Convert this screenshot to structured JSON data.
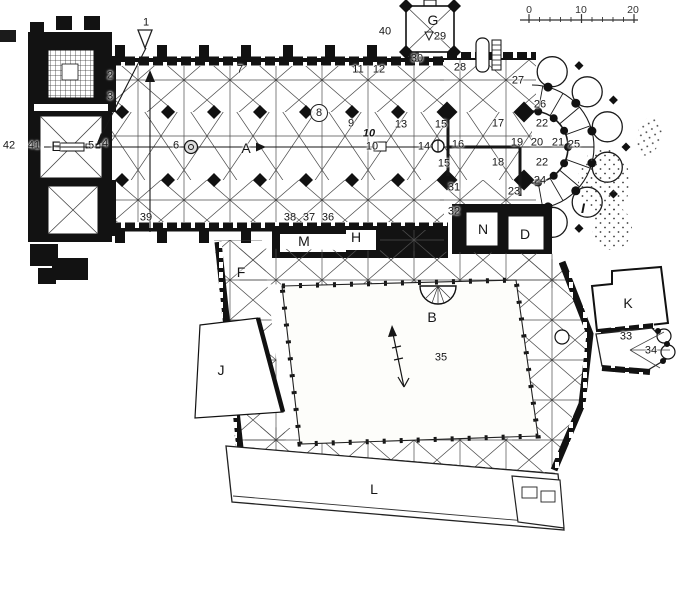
{
  "figure": {
    "kind": "architectural floor plan",
    "subject": "cathedral ground plan with cloister, scanned line drawing"
  },
  "scale_bar": {
    "labels": [
      "0",
      "10",
      "20"
    ]
  },
  "annotations": [
    {
      "text": "G",
      "x": 433,
      "y": 20,
      "kind": "ltr"
    },
    {
      "text": "E",
      "x": 56,
      "y": 146,
      "kind": "ltr"
    },
    {
      "text": "A",
      "x": 246,
      "y": 148,
      "kind": "ltr"
    },
    {
      "text": "I",
      "x": 583,
      "y": 208,
      "kind": "ltr",
      "italic": true
    },
    {
      "text": "N",
      "x": 483,
      "y": 229,
      "kind": "ltr"
    },
    {
      "text": "D",
      "x": 525,
      "y": 234,
      "kind": "ltr"
    },
    {
      "text": "M",
      "x": 304,
      "y": 241,
      "kind": "ltr"
    },
    {
      "text": "H",
      "x": 356,
      "y": 237,
      "kind": "ltr"
    },
    {
      "text": "F",
      "x": 241,
      "y": 272,
      "kind": "ltr"
    },
    {
      "text": "B",
      "x": 432,
      "y": 317,
      "kind": "ltr"
    },
    {
      "text": "J",
      "x": 221,
      "y": 370,
      "kind": "ltr"
    },
    {
      "text": "K",
      "x": 628,
      "y": 303,
      "kind": "ltr"
    },
    {
      "text": "L",
      "x": 374,
      "y": 489,
      "kind": "ltr"
    },
    {
      "text": "1",
      "x": 146,
      "y": 23,
      "kind": "num"
    },
    {
      "text": "2",
      "x": 110,
      "y": 76,
      "kind": "num"
    },
    {
      "text": "3",
      "x": 110,
      "y": 97,
      "kind": "num"
    },
    {
      "text": "4",
      "x": 105,
      "y": 144,
      "kind": "num"
    },
    {
      "text": "5",
      "x": 91,
      "y": 146,
      "kind": "num"
    },
    {
      "text": "6",
      "x": 176,
      "y": 146,
      "kind": "num"
    },
    {
      "text": "7",
      "x": 240,
      "y": 70,
      "kind": "num"
    },
    {
      "text": "8",
      "x": 319,
      "y": 113,
      "kind": "num",
      "circled": true
    },
    {
      "text": "9",
      "x": 351,
      "y": 124,
      "kind": "num"
    },
    {
      "text": "10",
      "x": 369,
      "y": 134,
      "kind": "num",
      "italic": true
    },
    {
      "text": "10",
      "x": 372,
      "y": 147,
      "kind": "num"
    },
    {
      "text": "11",
      "x": 358,
      "y": 70,
      "kind": "num"
    },
    {
      "text": "12",
      "x": 379,
      "y": 70,
      "kind": "num"
    },
    {
      "text": "13",
      "x": 401,
      "y": 125,
      "kind": "num"
    },
    {
      "text": "14",
      "x": 424,
      "y": 147,
      "kind": "num"
    },
    {
      "text": "15",
      "x": 441,
      "y": 125,
      "kind": "num"
    },
    {
      "text": "15",
      "x": 444,
      "y": 164,
      "kind": "num"
    },
    {
      "text": "16",
      "x": 458,
      "y": 145,
      "kind": "num"
    },
    {
      "text": "17",
      "x": 498,
      "y": 124,
      "kind": "num"
    },
    {
      "text": "18",
      "x": 498,
      "y": 163,
      "kind": "num"
    },
    {
      "text": "19",
      "x": 517,
      "y": 143,
      "kind": "num"
    },
    {
      "text": "20",
      "x": 537,
      "y": 143,
      "kind": "num"
    },
    {
      "text": "21",
      "x": 558,
      "y": 143,
      "kind": "num"
    },
    {
      "text": "22",
      "x": 542,
      "y": 124,
      "kind": "num"
    },
    {
      "text": "22",
      "x": 542,
      "y": 163,
      "kind": "num"
    },
    {
      "text": "23",
      "x": 514,
      "y": 192,
      "kind": "num"
    },
    {
      "text": "24",
      "x": 540,
      "y": 181,
      "kind": "num"
    },
    {
      "text": "25",
      "x": 574,
      "y": 145,
      "kind": "num"
    },
    {
      "text": "26",
      "x": 540,
      "y": 105,
      "kind": "num"
    },
    {
      "text": "27",
      "x": 518,
      "y": 81,
      "kind": "num"
    },
    {
      "text": "28",
      "x": 460,
      "y": 68,
      "kind": "num"
    },
    {
      "text": "29",
      "x": 440,
      "y": 37,
      "kind": "num"
    },
    {
      "text": "30",
      "x": 417,
      "y": 59,
      "kind": "num"
    },
    {
      "text": "31",
      "x": 454,
      "y": 188,
      "kind": "num"
    },
    {
      "text": "32",
      "x": 454,
      "y": 212,
      "kind": "num"
    },
    {
      "text": "33",
      "x": 626,
      "y": 337,
      "kind": "num"
    },
    {
      "text": "34",
      "x": 651,
      "y": 351,
      "kind": "num"
    },
    {
      "text": "35",
      "x": 441,
      "y": 358,
      "kind": "num"
    },
    {
      "text": "36",
      "x": 328,
      "y": 218,
      "kind": "num"
    },
    {
      "text": "37",
      "x": 309,
      "y": 218,
      "kind": "num"
    },
    {
      "text": "38",
      "x": 290,
      "y": 218,
      "kind": "num"
    },
    {
      "text": "39",
      "x": 146,
      "y": 218,
      "kind": "num"
    },
    {
      "text": "40",
      "x": 385,
      "y": 32,
      "kind": "num"
    },
    {
      "text": "41",
      "x": 34,
      "y": 146,
      "kind": "num"
    },
    {
      "text": "42",
      "x": 9,
      "y": 146,
      "kind": "num"
    }
  ]
}
